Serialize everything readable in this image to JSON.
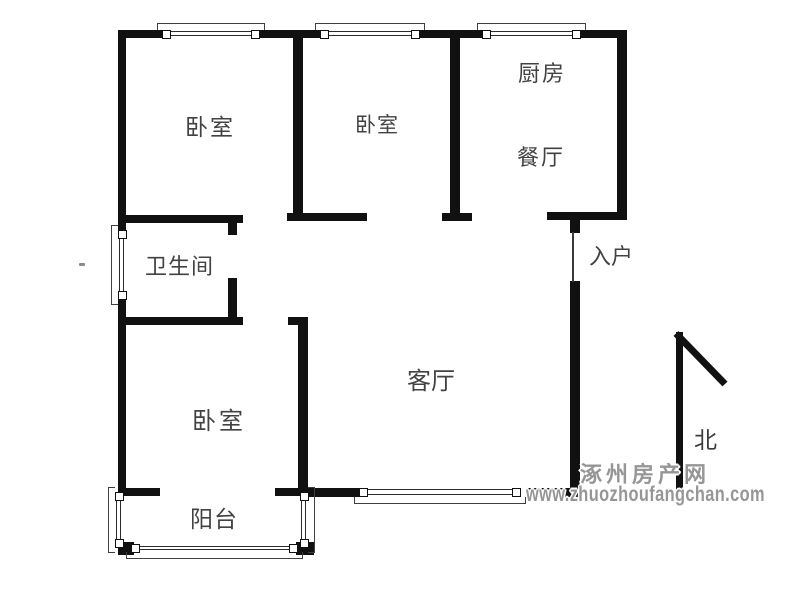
{
  "page": {
    "background": "#ffffff"
  },
  "colors": {
    "wall": "#111111",
    "window_line": "#2b2b2b",
    "label_text": "#424242",
    "watermark": "#969696"
  },
  "rooms": {
    "bedroom_top_left": "卧室",
    "bedroom_top_middle": "卧室",
    "kitchen": "厨房",
    "dining": "餐厅",
    "bathroom": "卫生间",
    "entry": "入户",
    "living_room": "客厅",
    "bedroom_bottom": "卧室",
    "balcony": "阳台"
  },
  "compass": {
    "north_label": "北"
  },
  "watermark": {
    "site_name": "涿州房产网",
    "url": "www.zhuozhoufangchan.com"
  }
}
